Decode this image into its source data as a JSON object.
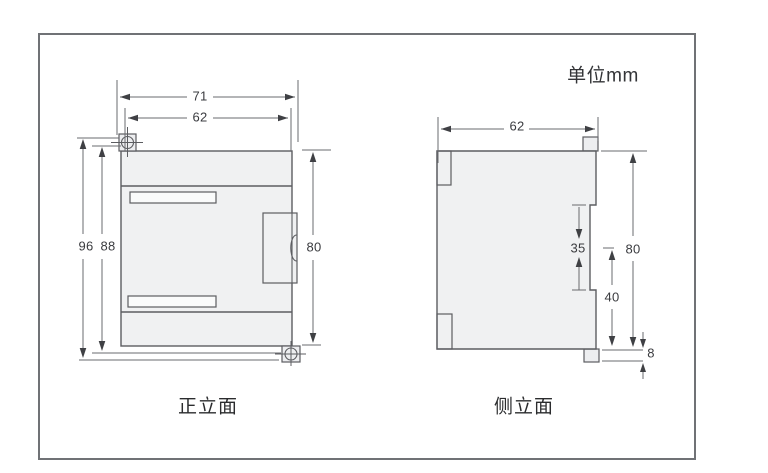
{
  "unit_label": "单位mm",
  "front_view": {
    "caption": "正立面",
    "dims": {
      "overall_width": "71",
      "body_width": "62",
      "overall_height": "96",
      "mount_height": "88",
      "body_height": "80"
    }
  },
  "side_view": {
    "caption": "侧立面",
    "dims": {
      "depth": "62",
      "din_rail_width": "35",
      "body_height": "80",
      "lower_height": "40",
      "tab_height": "8"
    }
  },
  "colors": {
    "outline": "#5c5d61",
    "frame_border": "#707276",
    "body_fill": "#f0f1f2",
    "arrow": "#3f4044",
    "text": "#3a3b3f"
  }
}
